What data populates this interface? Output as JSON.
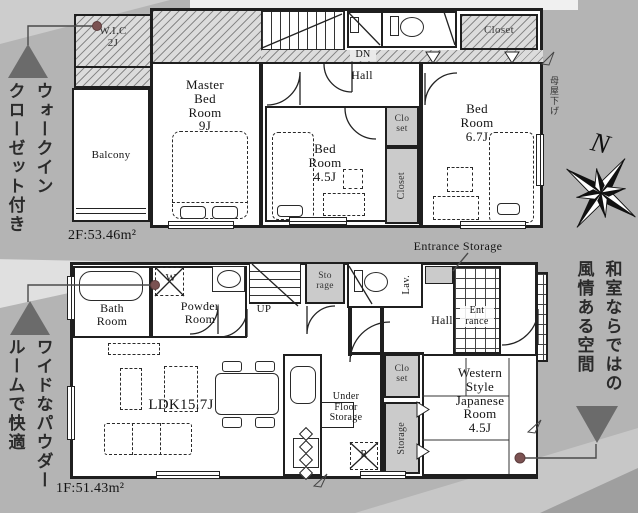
{
  "colors": {
    "page_bg": "#b4b4b4",
    "plan_bg": "#ffffff",
    "wall": "#1f1f1f",
    "hatch_bg": "#dcdcdc",
    "shade": "#cbcbcb",
    "marker_gray": "#6b6b6b",
    "callout_dot": "#7b5252"
  },
  "annotations": {
    "walk_in_closet": {
      "lines": [
        "ウォークイン",
        "クローゼット付き"
      ]
    },
    "powder": {
      "lines": [
        "ワイドなパウダー",
        "ルームで快適"
      ]
    },
    "japanese": {
      "lines": [
        "和室ならではの",
        "風情ある空間"
      ]
    },
    "moya_sage": "母屋下げ",
    "entrance_storage": "Entrance Storage"
  },
  "compass": {
    "north": "N"
  },
  "floor2": {
    "area": "2F:53.46m²",
    "wic": {
      "lines": [
        "W.I.C",
        "2J"
      ]
    },
    "balcony": "Balcony",
    "master": {
      "lines": [
        "Master",
        "Bed",
        "Room"
      ],
      "size": "9J"
    },
    "bed_small": {
      "lines": [
        "Bed",
        "Room"
      ],
      "size": "4.5J"
    },
    "bed_large": {
      "lines": [
        "Bed",
        "Room"
      ],
      "size": "6.7J"
    },
    "hall": "Hall",
    "dn": "DN",
    "closet_top": "Closet",
    "closet_mid": {
      "lines": [
        "Clo",
        "set"
      ]
    },
    "closet_side": "Closet"
  },
  "floor1": {
    "area": "1F:51.43m²",
    "bath": {
      "lines": [
        "Bath",
        "Room"
      ]
    },
    "powder": {
      "lines": [
        "Powder",
        "Room"
      ]
    },
    "washer": "W",
    "up": "UP",
    "storage_top": {
      "lines": [
        "Sto",
        "rage"
      ]
    },
    "lav": "Lav.",
    "hall": "Hall",
    "entrance": {
      "lines": [
        "Ent",
        "rance"
      ]
    },
    "ldk": "LDK15.7J",
    "under_floor": {
      "lines": [
        "Under",
        "Floor",
        "Storage"
      ]
    },
    "fridge": "R",
    "closet": {
      "lines": [
        "Clo",
        "set"
      ]
    },
    "storage_side": "Storage",
    "japanese": {
      "lines": [
        "Western",
        "Style",
        "Japanese",
        "Room"
      ],
      "size": "4.5J"
    }
  }
}
